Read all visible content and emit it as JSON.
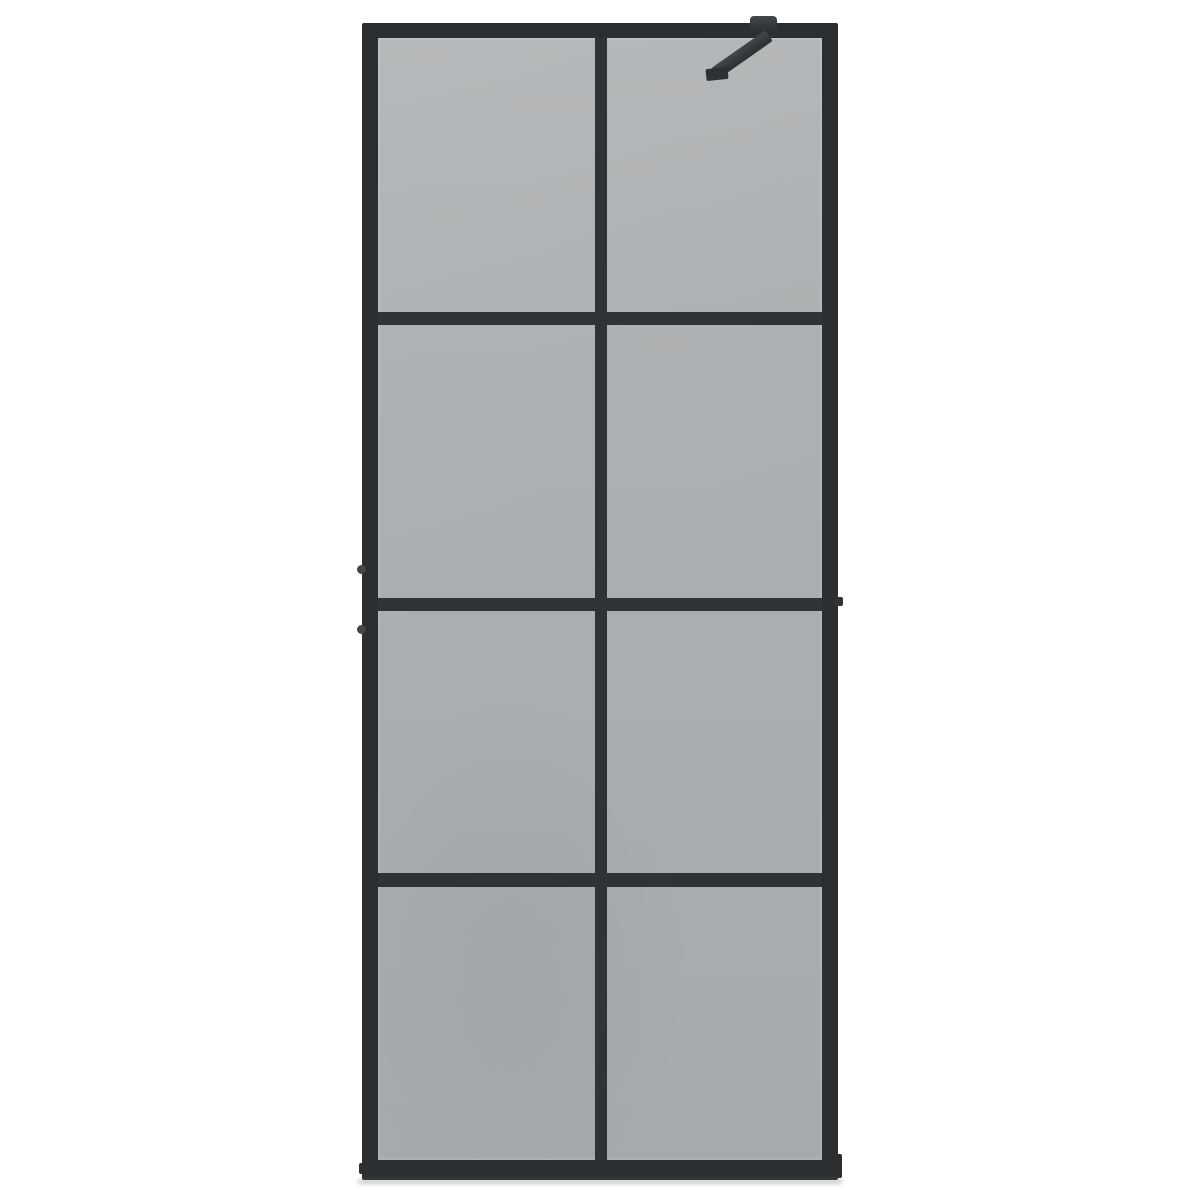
{
  "scene": {
    "type": "product-photo",
    "subject": "Walk-in shower screen with smoke tinted glass and black frame",
    "description": "Front view of a walk-in shower glass wall: smoke-grey tinted glass in a matte black aluminium frame divided into a 2-column by 4-row pane grid, with a black diagonal support stabilizer bar clamped to the top right of the frame, on a plain white background",
    "visible_text": "",
    "background_color": "#ffffff"
  },
  "panel": {
    "grid_columns": 2,
    "grid_rows": 4,
    "pane_count": 8,
    "frame_finish": "matte black",
    "glass_finish": "smoke tinted grey"
  },
  "hardware": {
    "support_bar": "diagonal stabilizer arm at top right, angled about 35 degrees",
    "clamp": "support-bar clamp seated on top edge of frame",
    "wall_anchor_count": 2,
    "wall_anchor_position": "left frame rail, mid-height",
    "side_bracket": "small bracket stub on right rail at middle mullion"
  },
  "colors": {
    "background": "#ffffff",
    "frame": "#2c2f31",
    "mullion": "#2f3335",
    "glass-top": "#aeb1b3",
    "glass-mid": "#aaaeb0",
    "glass-bottom": "#a6aaac",
    "hardware": "#43474a",
    "hardware-dark": "#2e3133",
    "shadow": "rgba(100,103,105,0.35)"
  }
}
